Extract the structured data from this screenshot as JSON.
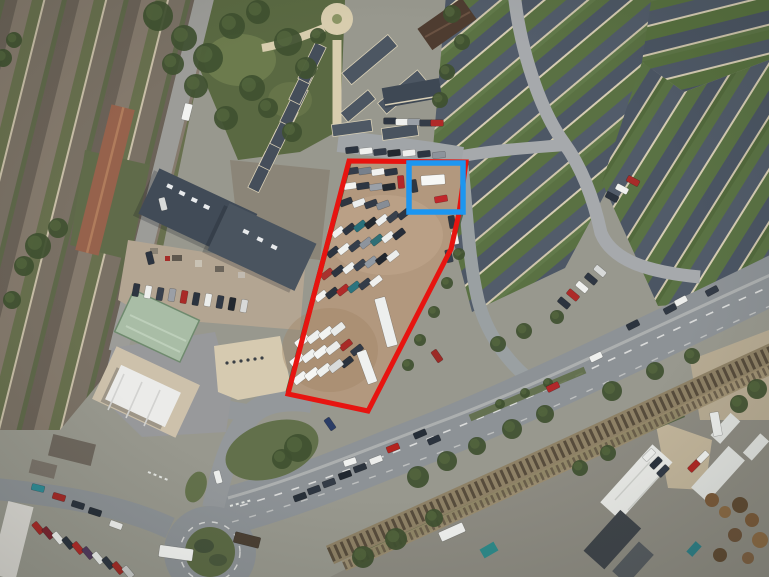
{
  "canvas": {
    "width": 769,
    "height": 577,
    "kind": "aerial-satellite-photo"
  },
  "palette": {
    "boundary_red": "#e71410",
    "highlight_blue": "#1d96f0",
    "lot_surface": "#b2987e",
    "road_grey": "#8d9296",
    "roof_slate": "#4d5765",
    "garden_green": "#5a7143",
    "railway_rust": "#8e8166"
  },
  "annotations": {
    "site_boundary": {
      "name": "site-boundary-outline",
      "color": "#e71410",
      "stroke_width": 5,
      "points": [
        [
          349,
          161
        ],
        [
          466,
          162
        ],
        [
          459,
          213
        ],
        [
          451,
          249
        ],
        [
          368,
          411
        ],
        [
          288,
          394
        ]
      ]
    },
    "highlight_box": {
      "name": "highlight-box",
      "color": "#1d96f0",
      "stroke_width": 5.5,
      "x": 409,
      "y": 163,
      "width": 54,
      "height": 49
    }
  },
  "scene": {
    "cars": [
      [
        352,
        171,
        -8,
        "#343c49"
      ],
      [
        365,
        171,
        -8,
        "#77808c"
      ],
      [
        378,
        172,
        -8,
        "#f1f1ef"
      ],
      [
        391,
        172,
        -8,
        "#2c3440"
      ],
      [
        401,
        182,
        85,
        "#b3282a"
      ],
      [
        350,
        186,
        -8,
        "#f2f2f0"
      ],
      [
        363,
        186,
        -8,
        "#2e3642"
      ],
      [
        376,
        187,
        -8,
        "#9aa0a8"
      ],
      [
        389,
        187,
        -8,
        "#22282f"
      ],
      [
        346,
        202,
        -20,
        "#2d3540"
      ],
      [
        359,
        203,
        -20,
        "#eceeee"
      ],
      [
        371,
        204,
        -20,
        "#313946"
      ],
      [
        383,
        205,
        -20,
        "#868d96"
      ],
      [
        338,
        232,
        -38,
        "#f1f2f0"
      ],
      [
        349,
        229,
        -38,
        "#2c3440"
      ],
      [
        360,
        226,
        -38,
        "#28707a"
      ],
      [
        371,
        223,
        -38,
        "#22282f"
      ],
      [
        382,
        220,
        -38,
        "#eef0ef"
      ],
      [
        393,
        217,
        -38,
        "#39414d"
      ],
      [
        404,
        214,
        -38,
        "#2e3643"
      ],
      [
        333,
        252,
        -38,
        "#2b333f"
      ],
      [
        344,
        249,
        -38,
        "#f0f1ef"
      ],
      [
        355,
        246,
        -38,
        "#343d4a"
      ],
      [
        366,
        243,
        -38,
        "#8d949d"
      ],
      [
        377,
        240,
        -38,
        "#2f6f76"
      ],
      [
        388,
        237,
        -38,
        "#edefee"
      ],
      [
        399,
        234,
        -38,
        "#262d38"
      ],
      [
        327,
        274,
        -38,
        "#a8322e"
      ],
      [
        338,
        271,
        -38,
        "#2c343f"
      ],
      [
        349,
        268,
        -38,
        "#eff0ee"
      ],
      [
        360,
        265,
        -38,
        "#39424f"
      ],
      [
        371,
        262,
        -38,
        "#9099a3"
      ],
      [
        382,
        259,
        -38,
        "#21262e"
      ],
      [
        393,
        256,
        -38,
        "#eceeed"
      ],
      [
        321,
        296,
        -38,
        "#f0f1ef"
      ],
      [
        332,
        293,
        -38,
        "#2a323d"
      ],
      [
        343,
        290,
        -38,
        "#b02b29"
      ],
      [
        354,
        287,
        -38,
        "#2d747e"
      ],
      [
        365,
        284,
        -38,
        "#343c48"
      ],
      [
        376,
        281,
        -38,
        "#f0f0ee"
      ],
      [
        346,
        345,
        -38,
        "#a82a27"
      ],
      [
        347,
        362,
        -38,
        "#2a323d"
      ],
      [
        357,
        350,
        -38,
        "#323a47"
      ],
      [
        452,
        222,
        80,
        "#2e3641"
      ],
      [
        455,
        238,
        80,
        "#eff0ee"
      ],
      [
        449,
        256,
        78,
        "#39414e"
      ],
      [
        437,
        356,
        55,
        "#9c2a26"
      ],
      [
        441,
        199,
        -10,
        "#c0272b"
      ],
      [
        414,
        186,
        80,
        "#2f3742"
      ],
      [
        352,
        150,
        -6,
        "#2c3440"
      ],
      [
        366,
        151,
        -6,
        "#eff0ee"
      ],
      [
        380,
        152,
        -6,
        "#343c49"
      ],
      [
        394,
        153,
        -6,
        "#21272f"
      ],
      [
        409,
        153,
        -6,
        "#efefed"
      ],
      [
        424,
        154,
        -6,
        "#2d3541"
      ],
      [
        439,
        155,
        -6,
        "#8d939b"
      ],
      [
        300,
        497,
        -20,
        "#283039"
      ],
      [
        314,
        490,
        -20,
        "#2e3641"
      ],
      [
        329,
        483,
        -20,
        "#343c47"
      ],
      [
        345,
        475,
        -20,
        "#21272f"
      ],
      [
        360,
        468,
        -21,
        "#2b333d"
      ],
      [
        376,
        460,
        -21,
        "#ecedeb"
      ],
      [
        350,
        462,
        -18,
        "#f0f1ef"
      ],
      [
        393,
        448,
        -22,
        "#b4241f"
      ],
      [
        420,
        434,
        -23,
        "#262e38"
      ],
      [
        434,
        440,
        -23,
        "#2b333e"
      ],
      [
        553,
        387,
        -26,
        "#b1282a"
      ],
      [
        596,
        357,
        -26,
        "#eff0ee"
      ],
      [
        633,
        325,
        -27,
        "#2c343f"
      ],
      [
        670,
        309,
        -28,
        "#303843"
      ],
      [
        681,
        301,
        -28,
        "#edeeec"
      ],
      [
        712,
        291,
        -28,
        "#333b47"
      ],
      [
        38,
        488,
        14,
        "#2f8b96"
      ],
      [
        59,
        497,
        16,
        "#a42a28"
      ],
      [
        78,
        505,
        17,
        "#2b333e"
      ],
      [
        95,
        512,
        18,
        "#272f39"
      ],
      [
        116,
        525,
        20,
        "#f0f1ef"
      ],
      [
        218,
        477,
        75,
        "#eef0ee"
      ],
      [
        330,
        424,
        55,
        "#2b3d66"
      ],
      [
        163,
        204,
        76,
        "#d8dad9"
      ],
      [
        150,
        258,
        76,
        "#2c3440"
      ],
      [
        573,
        295,
        40,
        "#ad2a28"
      ],
      [
        564,
        303,
        40,
        "#2c343f"
      ],
      [
        582,
        287,
        40,
        "#eff0ee"
      ],
      [
        591,
        279,
        40,
        "#2e3642"
      ],
      [
        600,
        271,
        40,
        "#d7d9d8"
      ],
      [
        612,
        197,
        28,
        "#2b333e"
      ],
      [
        622,
        189,
        28,
        "#f0f1ef"
      ],
      [
        633,
        181,
        28,
        "#a82b29"
      ],
      [
        390,
        121,
        0,
        "#2d3541"
      ],
      [
        402,
        122,
        0,
        "#eff0ee"
      ],
      [
        414,
        122,
        0,
        "#9aa0a7"
      ],
      [
        426,
        123,
        0,
        "#343c48"
      ],
      [
        437,
        123,
        0,
        "#b02a28"
      ],
      [
        649,
        455,
        -45,
        "#eff0ee"
      ],
      [
        656,
        463,
        -45,
        "#2b333e"
      ],
      [
        663,
        471,
        -45,
        "#323a46"
      ],
      [
        694,
        466,
        -45,
        "#b02724"
      ],
      [
        703,
        457,
        -45,
        "#f1f2f0"
      ],
      [
        38,
        528,
        50,
        "#a72927"
      ],
      [
        48,
        533,
        50,
        "#7a2430"
      ],
      [
        58,
        538,
        50,
        "#eff0ee"
      ],
      [
        68,
        543,
        50,
        "#2b333e"
      ],
      [
        78,
        548,
        50,
        "#b02a28"
      ],
      [
        88,
        553,
        50,
        "#513a5e"
      ],
      [
        98,
        558,
        50,
        "#eceeec"
      ],
      [
        108,
        563,
        50,
        "#2e3642"
      ],
      [
        118,
        568,
        50,
        "#a22a26"
      ],
      [
        128,
        572,
        50,
        "#c9cbca"
      ],
      [
        136,
        290,
        100,
        "#2c3440"
      ],
      [
        148,
        292,
        100,
        "#eeefed"
      ],
      [
        160,
        294,
        100,
        "#39414d"
      ],
      [
        172,
        295,
        100,
        "#9b9fa6"
      ],
      [
        184,
        297,
        100,
        "#a92a27"
      ],
      [
        196,
        299,
        100,
        "#2b333e"
      ],
      [
        208,
        300,
        100,
        "#eceeec"
      ],
      [
        220,
        302,
        100,
        "#303844"
      ],
      [
        232,
        304,
        100,
        "#23282f"
      ],
      [
        244,
        306,
        100,
        "#d8d9d8"
      ]
    ],
    "vans": [
      [
        302,
        341,
        -38,
        "#f4f5f3"
      ],
      [
        314,
        337,
        -38,
        "#eef0ee"
      ],
      [
        326,
        333,
        -38,
        "#f2f3f1"
      ],
      [
        338,
        329,
        -38,
        "#e9ebe9"
      ],
      [
        297,
        360,
        -38,
        "#f3f4f2"
      ],
      [
        309,
        356,
        -38,
        "#eff1ef"
      ],
      [
        321,
        352,
        -38,
        "#f4f5f3"
      ],
      [
        333,
        348,
        -38,
        "#ecedeb"
      ],
      [
        300,
        378,
        -38,
        "#f2f3f1"
      ],
      [
        312,
        374,
        -38,
        "#f5f6f4"
      ],
      [
        324,
        370,
        -38,
        "#eef0ee"
      ],
      [
        336,
        366,
        -38,
        "#d9dbda"
      ]
    ],
    "trucks": [
      {
        "x": 433,
        "y": 180,
        "l": 24,
        "w": 10,
        "a": -4,
        "c": "#f6f7f5"
      },
      {
        "x": 386,
        "y": 322,
        "l": 50,
        "w": 11,
        "a": 75,
        "c": "#edefee"
      },
      {
        "x": 367,
        "y": 367,
        "l": 34,
        "w": 10,
        "a": 70,
        "c": "#eff1f0"
      },
      {
        "x": 176,
        "y": 553,
        "l": 34,
        "w": 12,
        "a": 8,
        "c": "#f4f5f3"
      },
      {
        "x": 247,
        "y": 540,
        "l": 26,
        "w": 11,
        "a": 14,
        "c": "#4b4034"
      },
      {
        "x": 187,
        "y": 112,
        "l": 17,
        "w": 8,
        "a": 104,
        "c": "#f2f3f1"
      },
      {
        "x": 452,
        "y": 532,
        "l": 26,
        "w": 10,
        "a": -24,
        "c": "#f0f1ef"
      },
      {
        "x": 716,
        "y": 424,
        "l": 24,
        "w": 9,
        "a": 80,
        "c": "#eceeec"
      }
    ],
    "trees": [
      [
        38,
        246,
        13
      ],
      [
        24,
        266,
        10
      ],
      [
        58,
        228,
        10
      ],
      [
        12,
        300,
        9
      ],
      [
        3,
        58,
        9
      ],
      [
        14,
        40,
        8
      ],
      [
        158,
        16,
        15
      ],
      [
        184,
        38,
        13
      ],
      [
        208,
        58,
        15
      ],
      [
        232,
        26,
        13
      ],
      [
        258,
        12,
        12
      ],
      [
        288,
        42,
        14
      ],
      [
        306,
        68,
        11
      ],
      [
        252,
        88,
        13
      ],
      [
        226,
        118,
        12
      ],
      [
        268,
        108,
        10
      ],
      [
        196,
        86,
        12
      ],
      [
        173,
        64,
        11
      ],
      [
        292,
        132,
        10
      ],
      [
        318,
        36,
        8
      ],
      [
        452,
        14,
        9
      ],
      [
        462,
        42,
        8
      ],
      [
        447,
        72,
        8
      ],
      [
        440,
        100,
        8
      ],
      [
        298,
        448,
        14
      ],
      [
        282,
        459,
        10
      ],
      [
        418,
        477,
        11
      ],
      [
        447,
        461,
        10
      ],
      [
        477,
        446,
        9
      ],
      [
        512,
        429,
        10
      ],
      [
        545,
        414,
        9
      ],
      [
        612,
        391,
        10
      ],
      [
        655,
        371,
        9
      ],
      [
        692,
        356,
        8
      ],
      [
        498,
        344,
        8
      ],
      [
        524,
        331,
        8
      ],
      [
        557,
        317,
        7
      ],
      [
        396,
        539,
        11
      ],
      [
        363,
        557,
        11
      ],
      [
        434,
        518,
        9
      ],
      [
        580,
        468,
        8
      ],
      [
        608,
        453,
        8
      ],
      [
        757,
        389,
        10
      ],
      [
        739,
        404,
        9
      ],
      [
        459,
        254,
        6
      ],
      [
        447,
        283,
        6
      ],
      [
        434,
        312,
        6
      ],
      [
        420,
        340,
        6
      ],
      [
        408,
        365,
        6
      ],
      [
        500,
        404,
        5
      ],
      [
        525,
        393,
        5
      ],
      [
        548,
        383,
        5
      ]
    ]
  }
}
